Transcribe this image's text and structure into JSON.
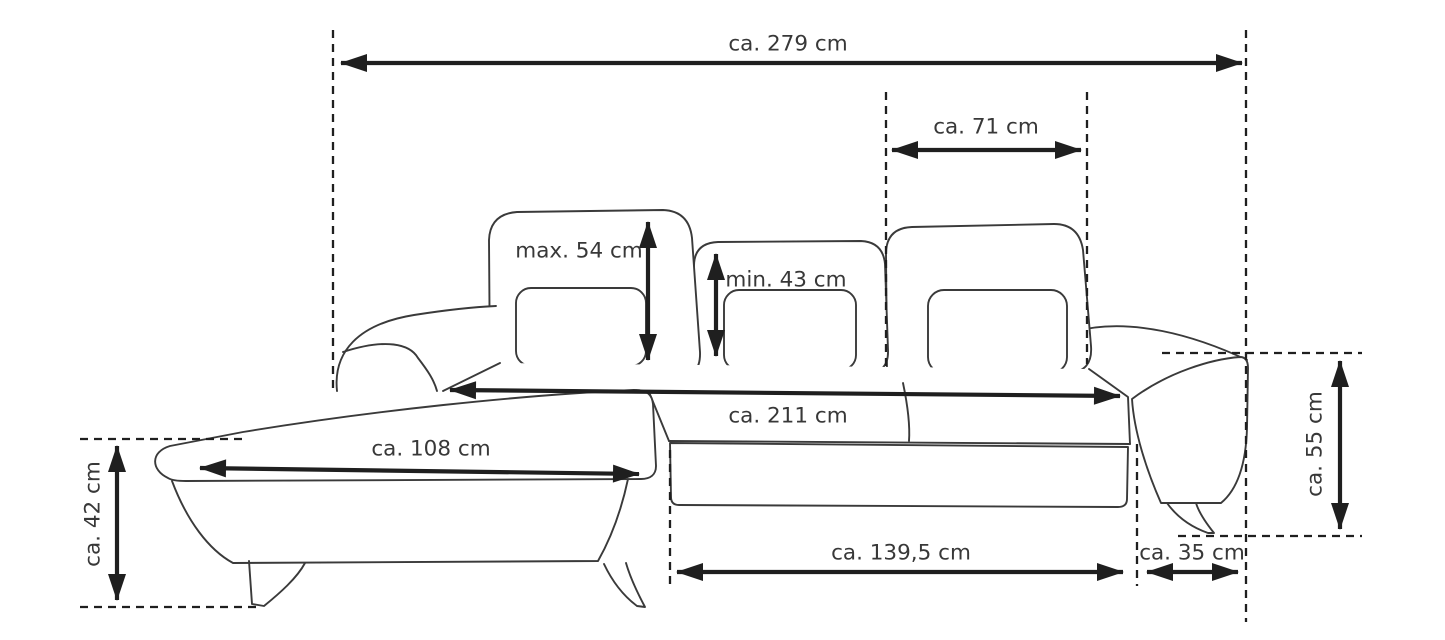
{
  "page": {
    "background_color": "#ffffff",
    "line_color": "#3a3a3a",
    "dimension_color": "#1f1f1f",
    "text_color": "#383838"
  },
  "diagram": {
    "type": "furniture-dimension-diagram",
    "subject": "corner sofa with chaise, three adjustable backrests, lumbar pillows and metal legs",
    "unit": "cm",
    "labels": {
      "overall_width": "ca. 279 cm",
      "headrest_width": "ca. 71 cm",
      "backrest_height_max": "max. 54 cm",
      "backrest_height_min": "min. 43 cm",
      "inner_seat_width": "ca. 211 cm",
      "chaise_width": "ca. 108 cm",
      "seat_height": "ca. 42 cm",
      "armrest_height": "ca. 55 cm",
      "seat_section_depth": "ca. 139,5 cm",
      "armrest_width": "ca. 35 cm"
    },
    "values_cm": {
      "overall_width": 279,
      "headrest_width": 71,
      "backrest_height_max": 54,
      "backrest_height_min": 43,
      "inner_seat_width": 211,
      "chaise_width": 108,
      "seat_height": 42,
      "armrest_height": 55,
      "seat_section_depth": 139.5,
      "armrest_width": 35
    }
  }
}
